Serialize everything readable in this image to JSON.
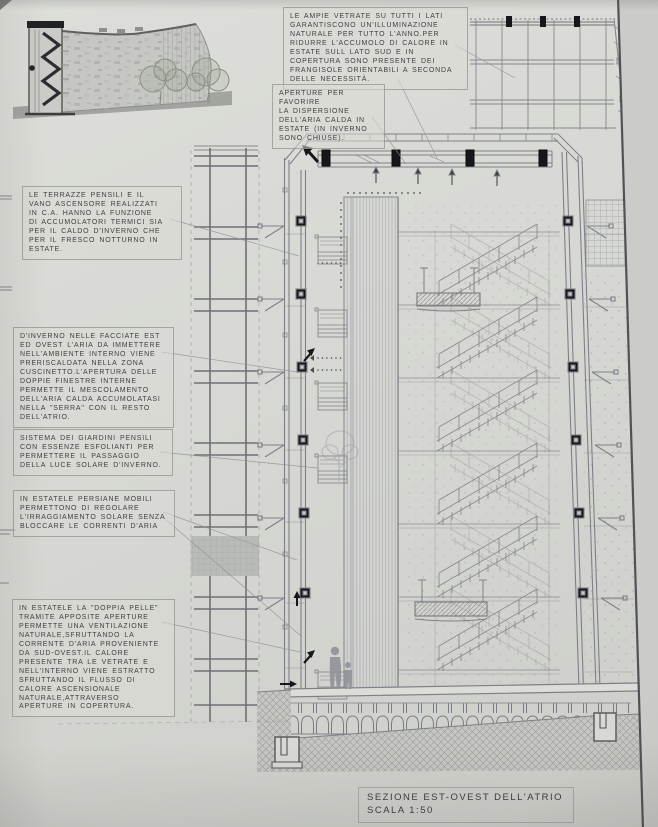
{
  "colors": {
    "paper": "#d8d9d4",
    "ink": "#3f4146",
    "drawing_line": "#7e8088",
    "black_elements": "#17171b",
    "ground_fill": "#c5c6c1",
    "sketch_tree_green": "#879284"
  },
  "annotations": [
    {
      "id": "note-vetrate",
      "text": "LE AMPIE VETRATE SU TUTTI I LATI\nGARANTISCONO UN'ILLUMINAZIONE\nNATURALE PER TUTTO L'ANNO.PER\nRIDURRE L'ACCUMOLO DI CALORE IN\nESTATE SULL LATO SUD E IN\nCOPERTURA SONO PRESENTE DEI\nFRANGISOLE ORIENTABILI A SECONDA\nDELLE NECESSITÀ."
    },
    {
      "id": "note-aperture",
      "text": "APERTURE PER FAVORIRE\nLA DISPERSIONE\nDELL'ARIA CALDA IN\nESTATE (IN INVERNO\nSONO CHIUSE)."
    },
    {
      "id": "note-terrazze",
      "text": "LE TERRAZZE PENSILI E IL\nVANO ASCENSORE REALIZZATI\nIN C.A. HANNO LA FUNZIONE\nDI ACCUMOLATORI TERMICI SIA\nPER IL CALDO D'INVERNO CHE\nPER IL FRESCO NOTTURNO IN\nESTATE."
    },
    {
      "id": "note-inverno",
      "text": "D'INVERNO NELLE FACCIATE EST\nED OVEST L'ARIA DA IMMETTERE\nNELL'AMBIENTE INTERNO VIENE\nPRERISCALDATA NELLA ZONA\nCUSCINETTO.L'APERTURA DELLE\nDOPPIE FINESTRE INTERNE\nPERMETTE IL MESCOLAMENTO\nDELL'ARIA CALDA ACCUMOLATASI\nNELLA \"SERRA\" CON IL RESTO\nDELL'ATRIO."
    },
    {
      "id": "note-giardini",
      "text": "SISTEMA DEI GIARDINI PENSILI\nCON ESSENZE ESFOLIANTI PER\nPERMETTERE IL PASSAGGIO\nDELLA LUCE SOLARE D'INVERNO."
    },
    {
      "id": "note-persiane",
      "text": "IN ESTATELE PERSIANE MOBILI\nPERMETTONO DI REGOLARE\nL'IRRAGGIAMENTO SOLARE SENZA\nBLOCCARE LE CORRENTI D'ARIA"
    },
    {
      "id": "note-doppia-pelle",
      "text": "IN ESTATELE LA \"DOPPIA PELLE\"\nTRAMITE APPOSITE APERTURE\nPERMETTE UNA VENTILAZIONE\nNATURALE,SFRUTTANDO LA\nCORRENTE D'ARIA PROVENIENTE\nDA SUD-OVEST.IL CALORE\nPRESENTE TRA LE VETRATE E\nNELL'INTERNO VIENE ESTRATTO\nSFRUTTANDO IL FLUSSO DI\nCALORE ASCENSIONALE\nNATURALE,ATTRAVERSO\nAPERTURE IN COPERTURA."
    }
  ],
  "title_block": {
    "title": "SEZIONE EST-OVEST DELL'ATRIO",
    "scale": "SCALA 1:50"
  }
}
